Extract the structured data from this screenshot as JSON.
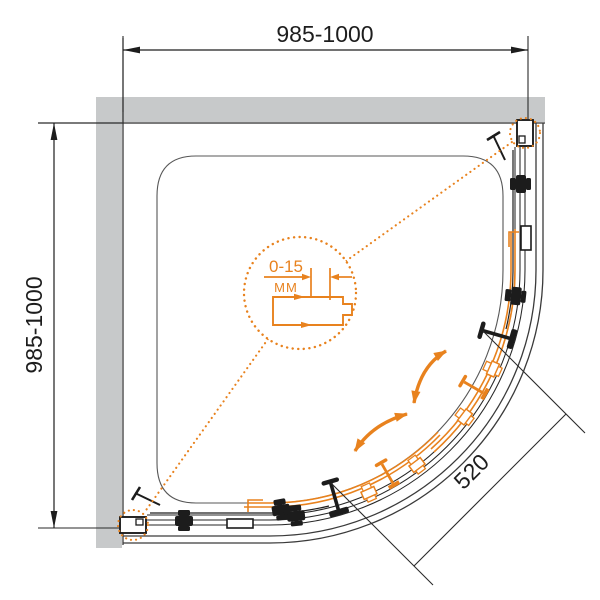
{
  "diagram": {
    "type": "technical-drawing",
    "subject": "quadrant-shower-enclosure-plan-view",
    "dimensions": {
      "width_top": "985-1000",
      "depth_left": "985-1000",
      "entry_width": "520"
    },
    "detail_callout": {
      "adjustment_range": "0-15",
      "unit": "MM"
    },
    "colors": {
      "accent_orange": "#E8821E",
      "wall_gray": "#C7C9CA",
      "line_black": "#232323",
      "dim_text": "#1D1D1D"
    },
    "components": {
      "walls": "tiled walls (top and left)",
      "tray": "quadrant shower tray",
      "doors": "two curved sliding doors",
      "handles": "two door handles",
      "profiles": "wall mounting profiles with 0-15 mm adjustment",
      "arrows": "door sliding directions"
    }
  }
}
